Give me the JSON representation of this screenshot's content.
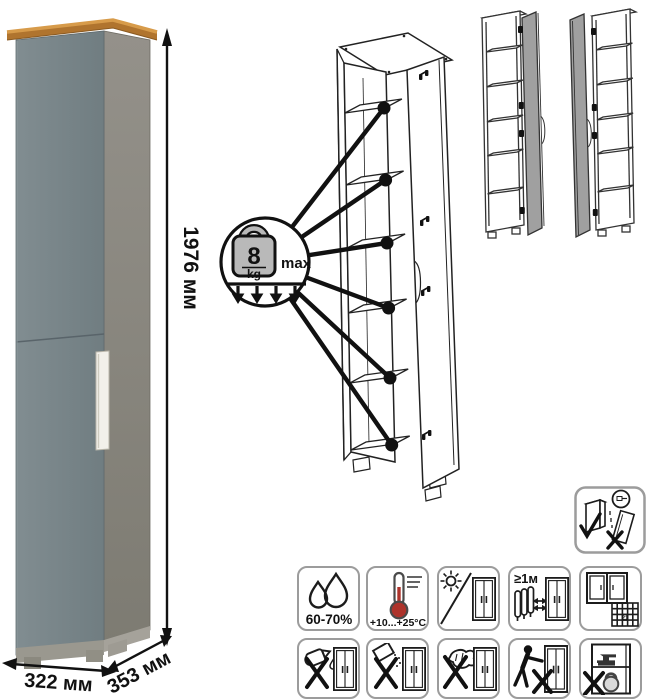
{
  "page": {
    "background": "#ffffff",
    "type": "furniture-product-diagram"
  },
  "dimensions": {
    "height_label": "1976 мм",
    "width_label": "322 мм",
    "depth_label": "353 мм"
  },
  "shelf_load_callout": {
    "value": "8",
    "unit": "kg",
    "qualifier": "max",
    "icon": "kettlebell-weight-icon",
    "arrows": 4,
    "load_points": 6
  },
  "views": {
    "product_render": "tall-single-door-cabinet-gray-with-wood-top",
    "assembly_view": "open-cabinet-line-drawing-with-6-shelf-load-points",
    "door_variants": [
      "door-hinged-right-variant",
      "door-hinged-left-variant"
    ]
  },
  "care_grid": {
    "row1": [
      {
        "icon": "humidity-drops-icon",
        "label": "60-70%"
      },
      {
        "icon": "temperature-thermometer-icon",
        "label": "+10...+25°C"
      },
      {
        "icon": "no-direct-sunlight-icon",
        "label": ""
      },
      {
        "icon": "keep-distance-from-heat-icon",
        "label": "≥1м"
      },
      {
        "icon": "ventilate-room-calendar-icon",
        "label": "21"
      }
    ],
    "row2": [
      {
        "icon": "no-pouring-liquids-icon"
      },
      {
        "icon": "no-abrasive-powders-icon"
      },
      {
        "icon": "no-harsh-scrubbing-icon"
      },
      {
        "icon": "no-dragging-icon"
      },
      {
        "icon": "no-overloading-icon"
      }
    ],
    "standalone": {
      "icon": "fix-to-wall-icon"
    }
  },
  "colors": {
    "door_gray": "#7a868a",
    "side_gray": "#8d8a82",
    "wood_top": "#c08038",
    "drawing_door_gray": "#a0a0a0",
    "icon_border": "#9c9c9c",
    "thermometer_red": "#ad332b",
    "line_black": "#1c1c1c"
  }
}
